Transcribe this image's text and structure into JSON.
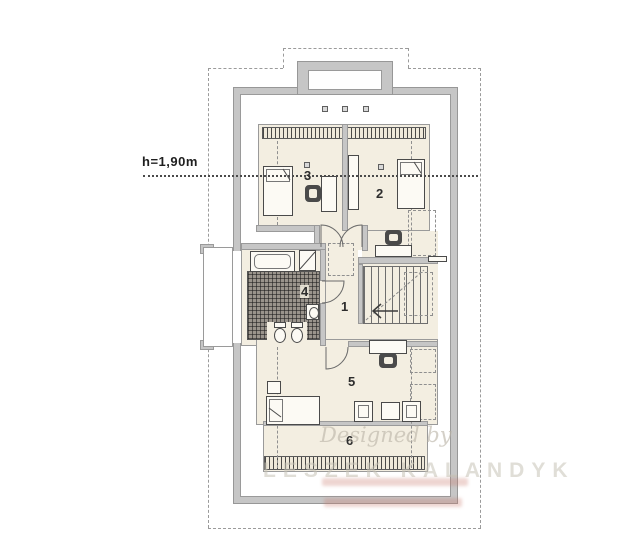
{
  "plan_title": "attic-floor-plan",
  "labels": {
    "height": "h=1,90m",
    "rooms": [
      "1",
      "2",
      "3",
      "4",
      "5",
      "6"
    ]
  },
  "watermark": {
    "script": "Designed by",
    "name": "LESZEK KALANDYK"
  },
  "colors": {
    "wall": "#c6c6c6",
    "wall_edge": "#979797",
    "floor": "#f3eee1",
    "tile_base": "#9a948c",
    "dashed_line": "#9b9b9b",
    "label_text": "#2d2d2d",
    "watermark": "#c7c2b7",
    "url_strip": "#c97c70"
  }
}
